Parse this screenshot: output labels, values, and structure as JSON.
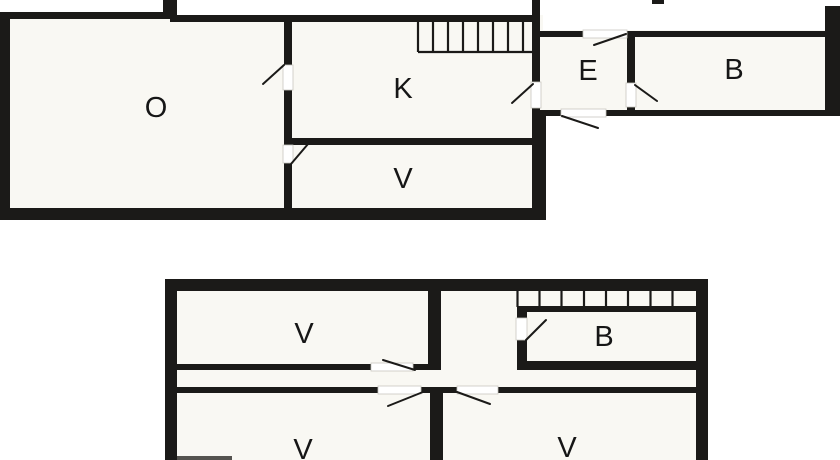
{
  "figure": {
    "type": "floor-plan",
    "levels": 2
  },
  "colors": {
    "wall": "#1b1a18",
    "background": "#ffffff",
    "floor_fill": "#f9f8f3",
    "opening_outline": "#c9c7c0",
    "label": "#161616"
  },
  "plans": {
    "upper": {
      "rooms": [
        {
          "label": "O"
        },
        {
          "label": "K"
        },
        {
          "label": "V"
        },
        {
          "label": "E"
        },
        {
          "label": "B"
        }
      ]
    },
    "lower": {
      "rooms": [
        {
          "label": "V"
        },
        {
          "label": "B"
        },
        {
          "label": "V"
        },
        {
          "label": "V"
        }
      ]
    }
  }
}
